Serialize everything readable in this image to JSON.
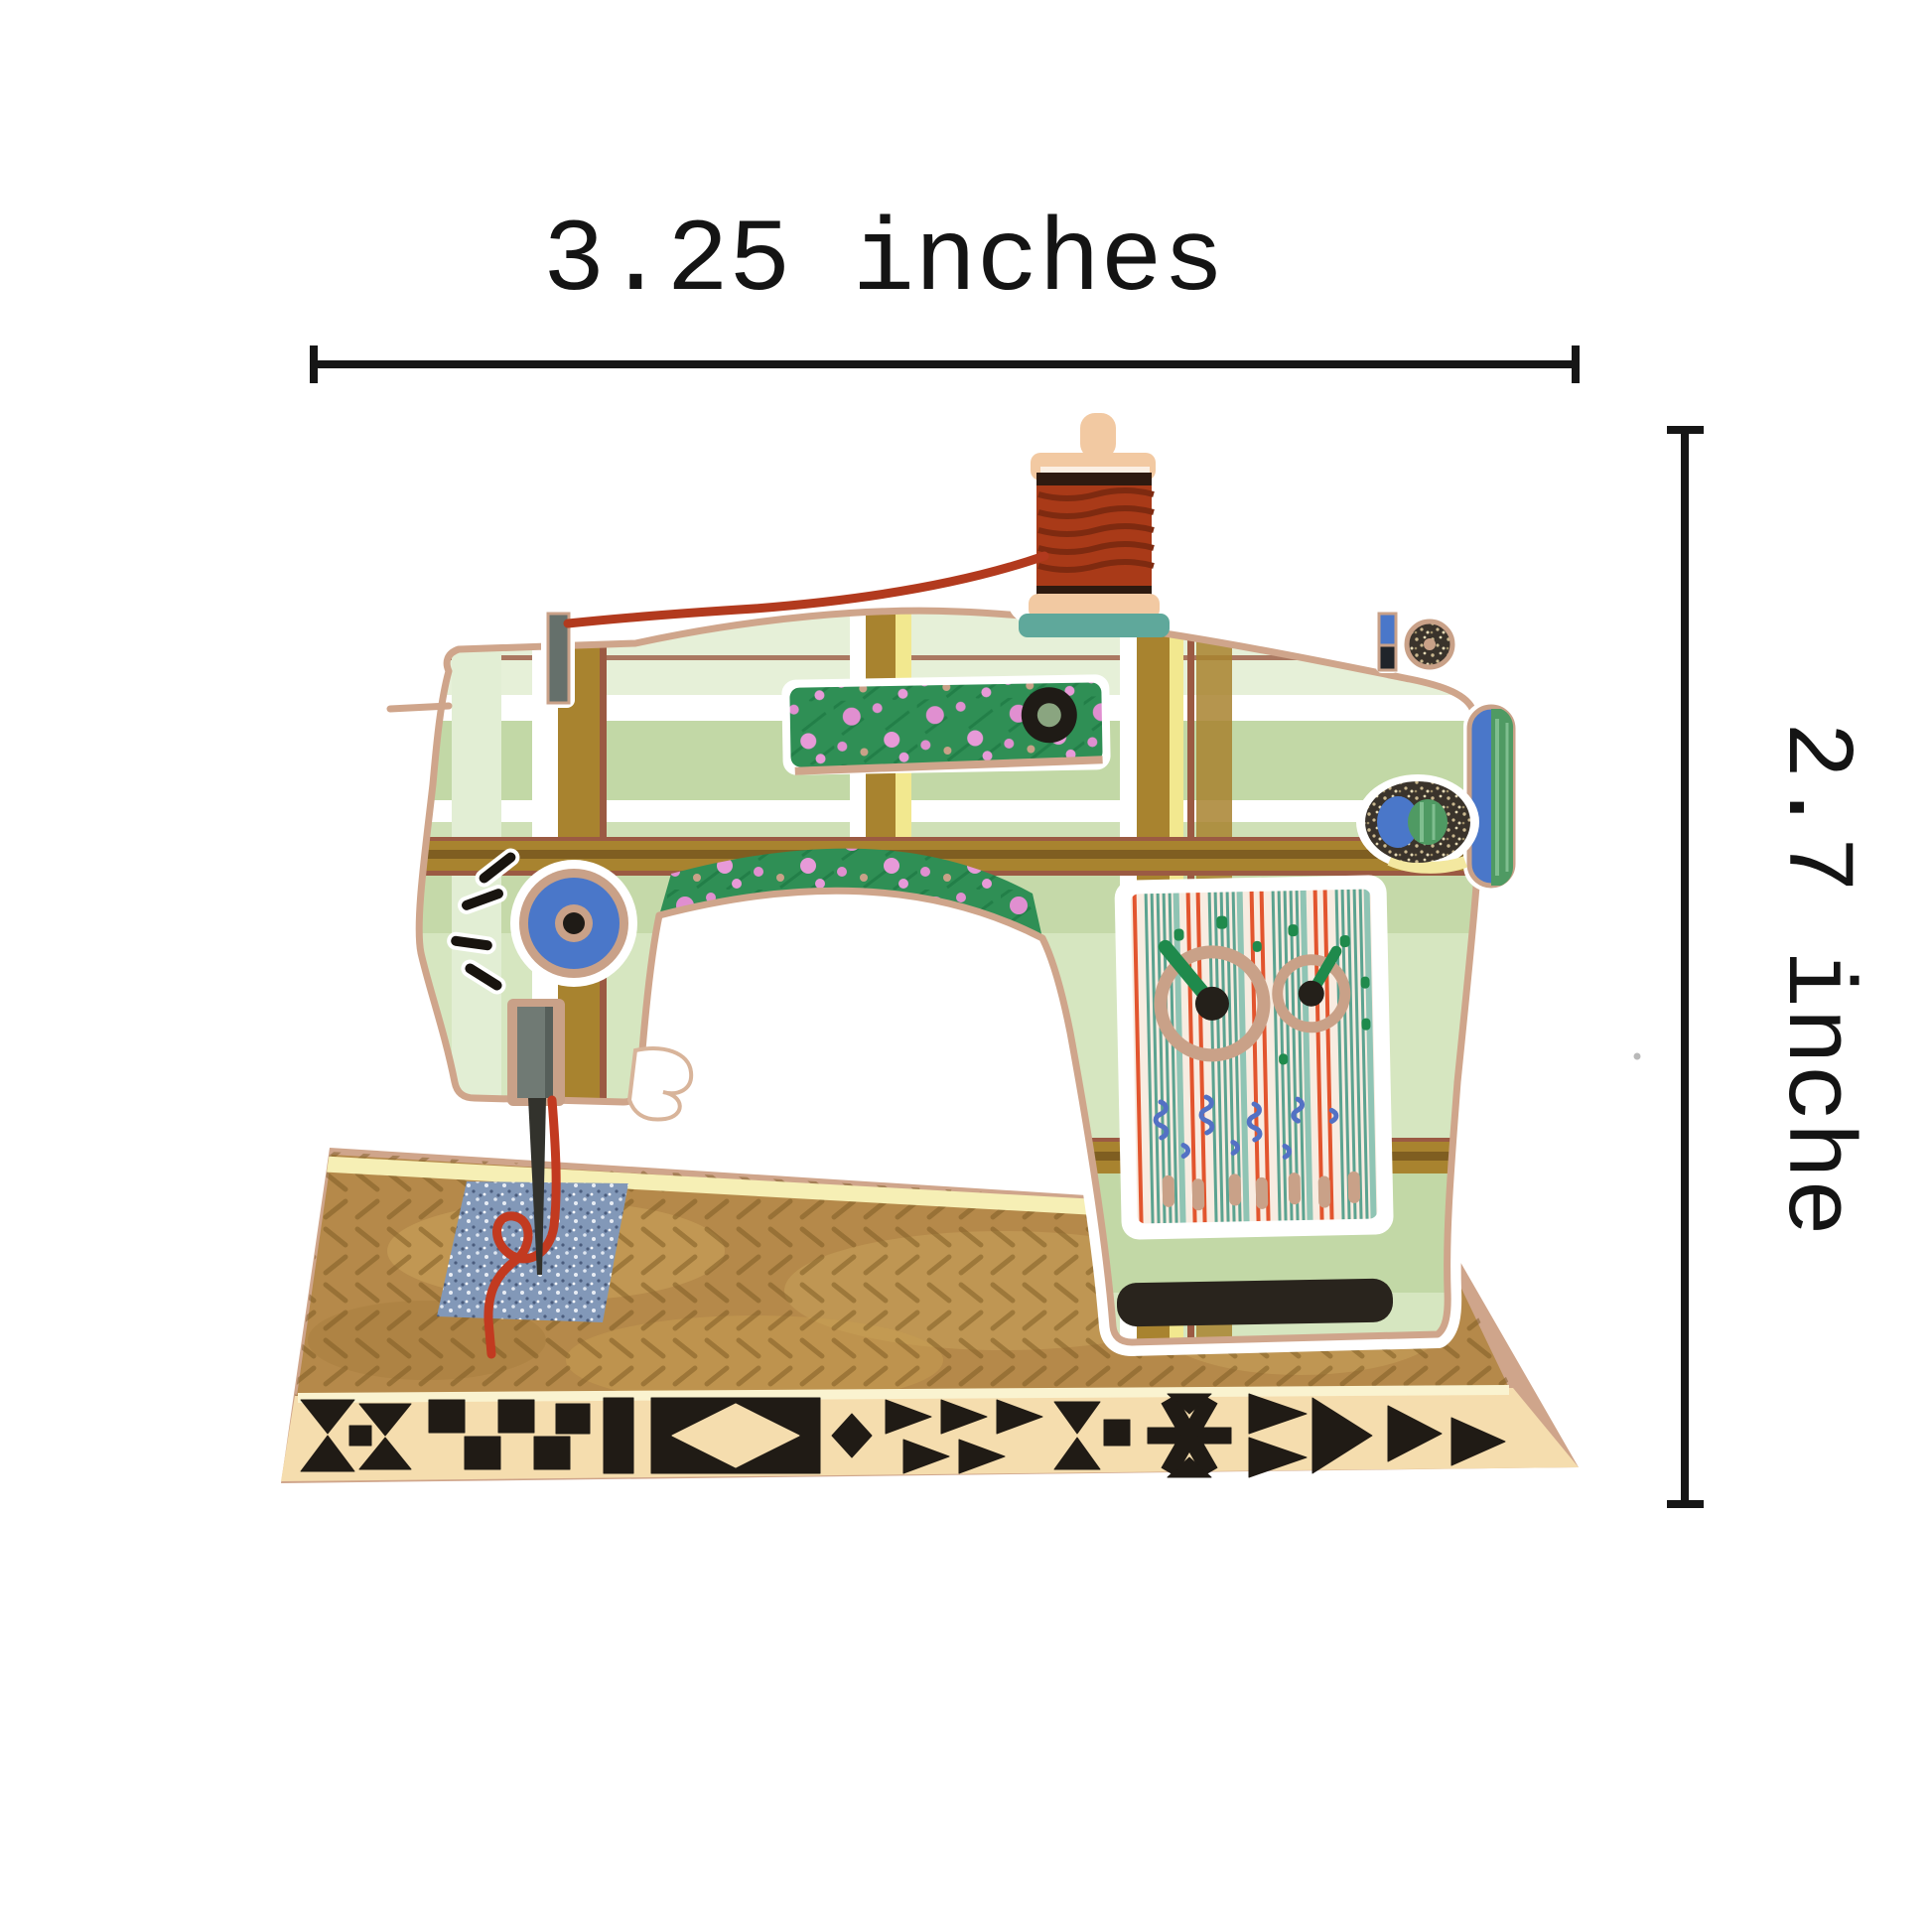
{
  "dimension_labels": {
    "width": "3.25 inches",
    "height": "2.7 inche"
  },
  "figure": {
    "subject": "sewing-machine-sticker-illustration",
    "colors": {
      "outline_beige": "#cfa58b",
      "sticker_white": "#ffffff",
      "fabric_green": "#d6e6c0",
      "fabric_green_pale": "#e6f0d8",
      "fabric_green_mid": "#c2d8a6",
      "plaid_mustard": "#a8832f",
      "plaid_brown_dark": "#7a5a20",
      "plaid_maroon": "#9b5a43",
      "plaid_yellow": "#f2e88f",
      "floral_green": "#2f8f55",
      "floral_pink": "#e08fd0",
      "thread_red": "#b23a1e",
      "spool_wood": "#f2c9a2",
      "spool_thread": "#a93a18",
      "spool_base_teal": "#5fa89b",
      "dial_blue": "#4a77c9",
      "panel_cream": "#f8ece1",
      "panel_teal": "#5ba390",
      "panel_orange": "#e2552e",
      "panel_blue": "#5371c4",
      "pointer_green": "#1f8a4c",
      "base_tan": "#b5894a",
      "band_cream": "#f5ddae",
      "pattern_black": "#201b15",
      "patch_blue": "#8298b8",
      "dimension_line": "#161616"
    }
  }
}
